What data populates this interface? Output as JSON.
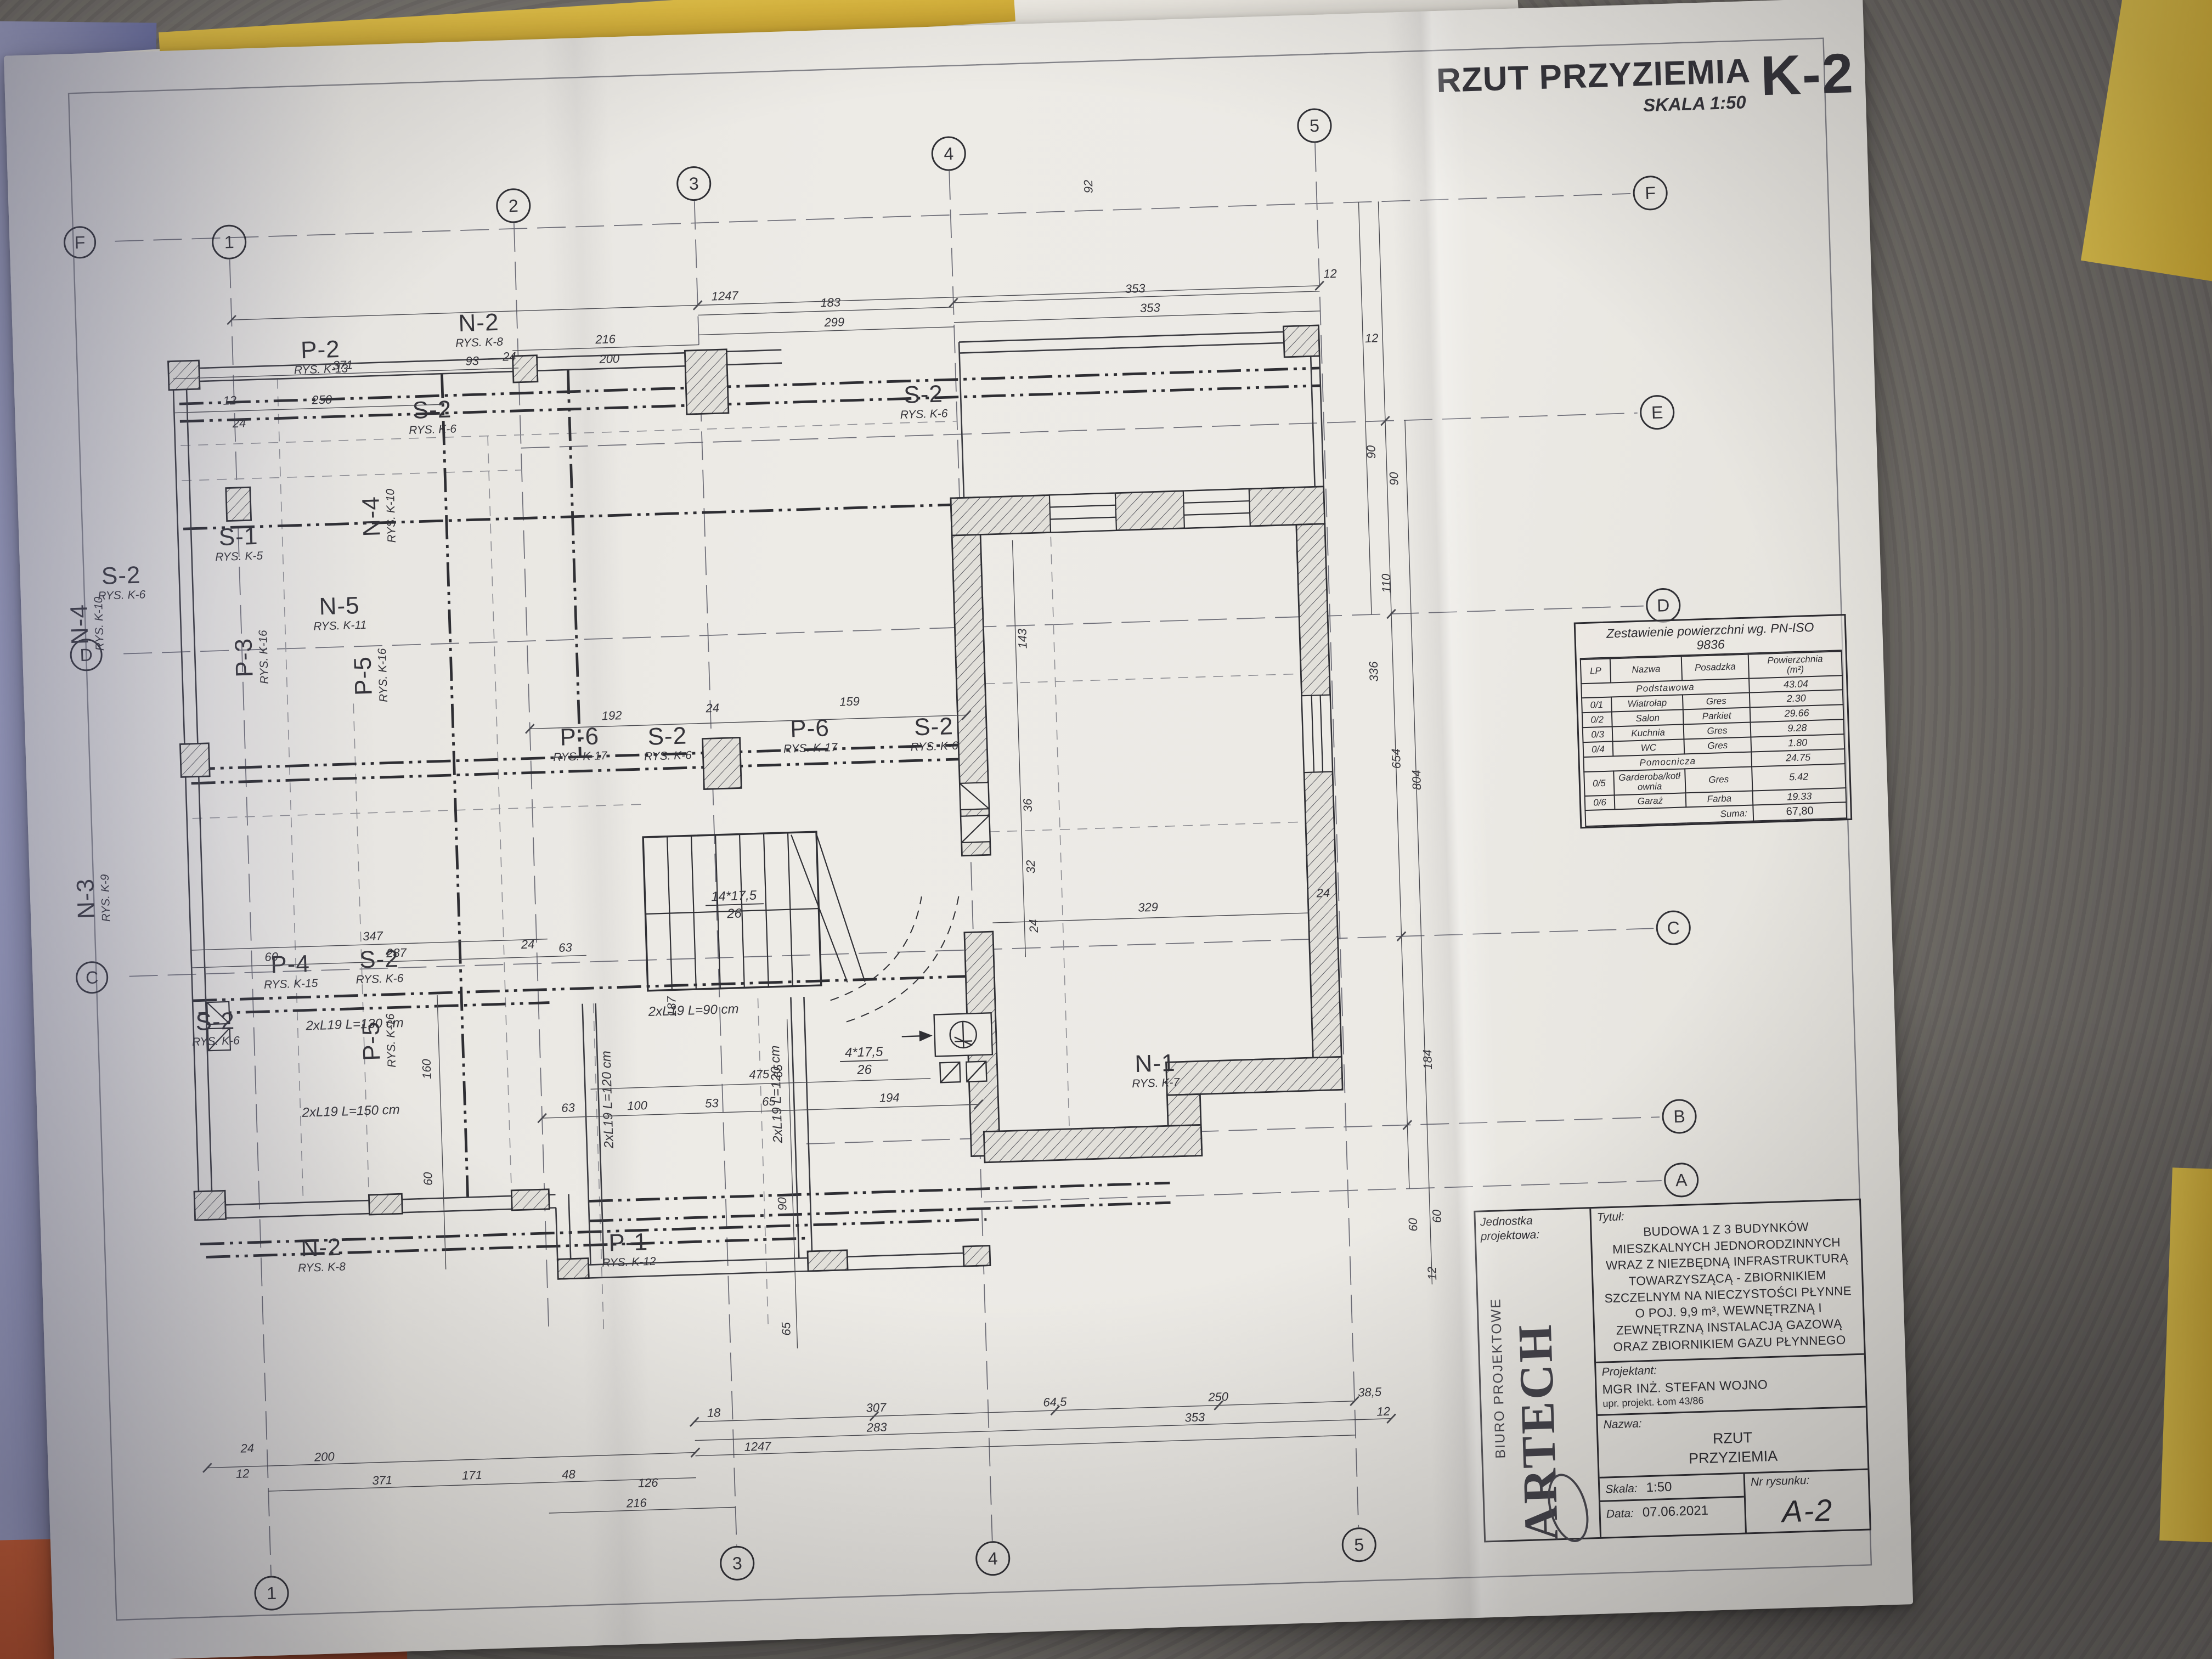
{
  "sheet": {
    "title": "RZUT PRZYZIEMIA",
    "scale": "SKALA 1:50",
    "code": "K-2"
  },
  "table": {
    "title1": "Zestawienie powierzchni wg. PN-ISO",
    "title2": "9836",
    "h_lp": "LP",
    "h_nazwa": "Nazwa",
    "h_pos": "Posadzka",
    "h_pow1": "Powierzchnia",
    "h_pow2": "(m²)",
    "rows": [
      {
        "lp": "",
        "nazwa": "Podstawowa",
        "pos": "",
        "pow": "43.04"
      },
      {
        "lp": "0/1",
        "nazwa": "Wiatrołap",
        "pos": "Gres",
        "pow": "2.30"
      },
      {
        "lp": "0/2",
        "nazwa": "Salon",
        "pos": "Parkiet",
        "pow": "29.66"
      },
      {
        "lp": "0/3",
        "nazwa": "Kuchnia",
        "pos": "Gres",
        "pow": "9.28"
      },
      {
        "lp": "0/4",
        "nazwa": "WC",
        "pos": "Gres",
        "pow": "1.80"
      },
      {
        "lp": "",
        "nazwa": "Pomocnicza",
        "pos": "",
        "pow": "24.75"
      },
      {
        "lp": "0/5",
        "nazwa": "Garderoba/kotłownia",
        "pos": "Gres",
        "pow": "5.42"
      },
      {
        "lp": "0/6",
        "nazwa": "Garaż",
        "pos": "Farba",
        "pow": "19.33"
      }
    ],
    "suma_label": "Suma:",
    "suma_value": "67,80"
  },
  "tblock": {
    "jednostka": "Jednostka projektowa:",
    "logo1": "BIURO PROJEKTOWE",
    "logo2": "ARTECH",
    "tytul_label": "Tytuł:",
    "tytul": "BUDOWA 1 Z 3 BUDYNKÓW MIESZKALNYCH JEDNORODZINNYCH WRAZ Z NIEZBĘDNĄ INFRASTRUKTURĄ TOWARZYSZĄCĄ - ZBIORNIKIEM SZCZELNYM NA NIECZYSTOŚCI PŁYNNE O POJ. 9,9 m³, WEWNĘTRZNĄ I ZEWNĘTRZNĄ INSTALACJĄ GAZOWĄ ORAZ ZBIORNIKIEM GAZU PŁYNNEGO",
    "proj_label": "Projektant:",
    "proj_name": "MGR INŻ. STEFAN WOJNO",
    "proj_upr": "upr. projekt. Łom 43/86",
    "nazwa_label": "Nazwa:",
    "nazwa": "RZUT\nPRZYZIEMIA",
    "skala_label": "Skala:",
    "skala": "1:50",
    "data_label": "Data:",
    "data": "07.06.2021",
    "nr_label": "Nr rysunku:",
    "nr": "A-2"
  },
  "grid": {
    "top": [
      "1",
      "2",
      "3",
      "4",
      "5"
    ],
    "bottom": [
      "1",
      "3",
      "4",
      "5"
    ],
    "right": [
      "F",
      "E",
      "D",
      "C",
      "B",
      "A"
    ],
    "left": [
      "F",
      "D",
      "C"
    ]
  },
  "elements": {
    "p1": {
      "name": "P-1",
      "rys": "RYS. K-12"
    },
    "p2": {
      "name": "P-2",
      "rys": "RYS. K-13"
    },
    "p3": {
      "name": "P-3",
      "rys": "RYS. K-16"
    },
    "p4": {
      "name": "P-4",
      "rys": "RYS. K-15"
    },
    "p5": {
      "name": "P-5",
      "rys": "RYS. K-16"
    },
    "p6": {
      "name": "P-6",
      "rys": "RYS. K-17"
    },
    "s1": {
      "name": "S-1",
      "rys": "RYS. K-5"
    },
    "s2": {
      "name": "S-2",
      "rys": "RYS. K-6"
    },
    "n1": {
      "name": "N-1",
      "rys": "RYS. K-7"
    },
    "n2": {
      "name": "N-2",
      "rys": "RYS. K-8"
    },
    "n3": {
      "name": "N-3",
      "rys": "RYS. K-9"
    },
    "n4": {
      "name": "N-4",
      "rys": "RYS. K-10"
    },
    "n5": {
      "name": "N-5",
      "rys": "RYS. K-11"
    }
  },
  "beams": {
    "b130": "2xL19 L=130 cm",
    "b90": "2xL19 L=90 cm",
    "b120": "2xL19 L=120 cm",
    "b150": "2xL19 L=150 cm"
  },
  "stairs": {
    "run_main": "14*17,5",
    "rise_main": "26",
    "run_winder": "4*17,5",
    "rise_winder": "26"
  },
  "dims": {
    "top": [
      "12",
      "24",
      "371",
      "93",
      "24",
      "250",
      "216",
      "200",
      "1247",
      "183",
      "299",
      "353",
      "353",
      "12"
    ],
    "bottom": [
      "12",
      "24",
      "200",
      "371",
      "171",
      "48",
      "126",
      "216",
      "1247",
      "18",
      "307",
      "283",
      "64,5",
      "250",
      "353",
      "38,5",
      "12"
    ],
    "right": [
      "12",
      "90",
      "90",
      "110",
      "92",
      "143",
      "36",
      "32",
      "24",
      "184",
      "60",
      "60",
      "12",
      "336",
      "654",
      "804",
      "24"
    ],
    "inner": [
      "192",
      "24",
      "159",
      "475",
      "63",
      "100",
      "53",
      "65",
      "194",
      "187",
      "347",
      "60",
      "287",
      "24",
      "63",
      "160",
      "60",
      "65",
      "90",
      "65",
      "329"
    ]
  }
}
